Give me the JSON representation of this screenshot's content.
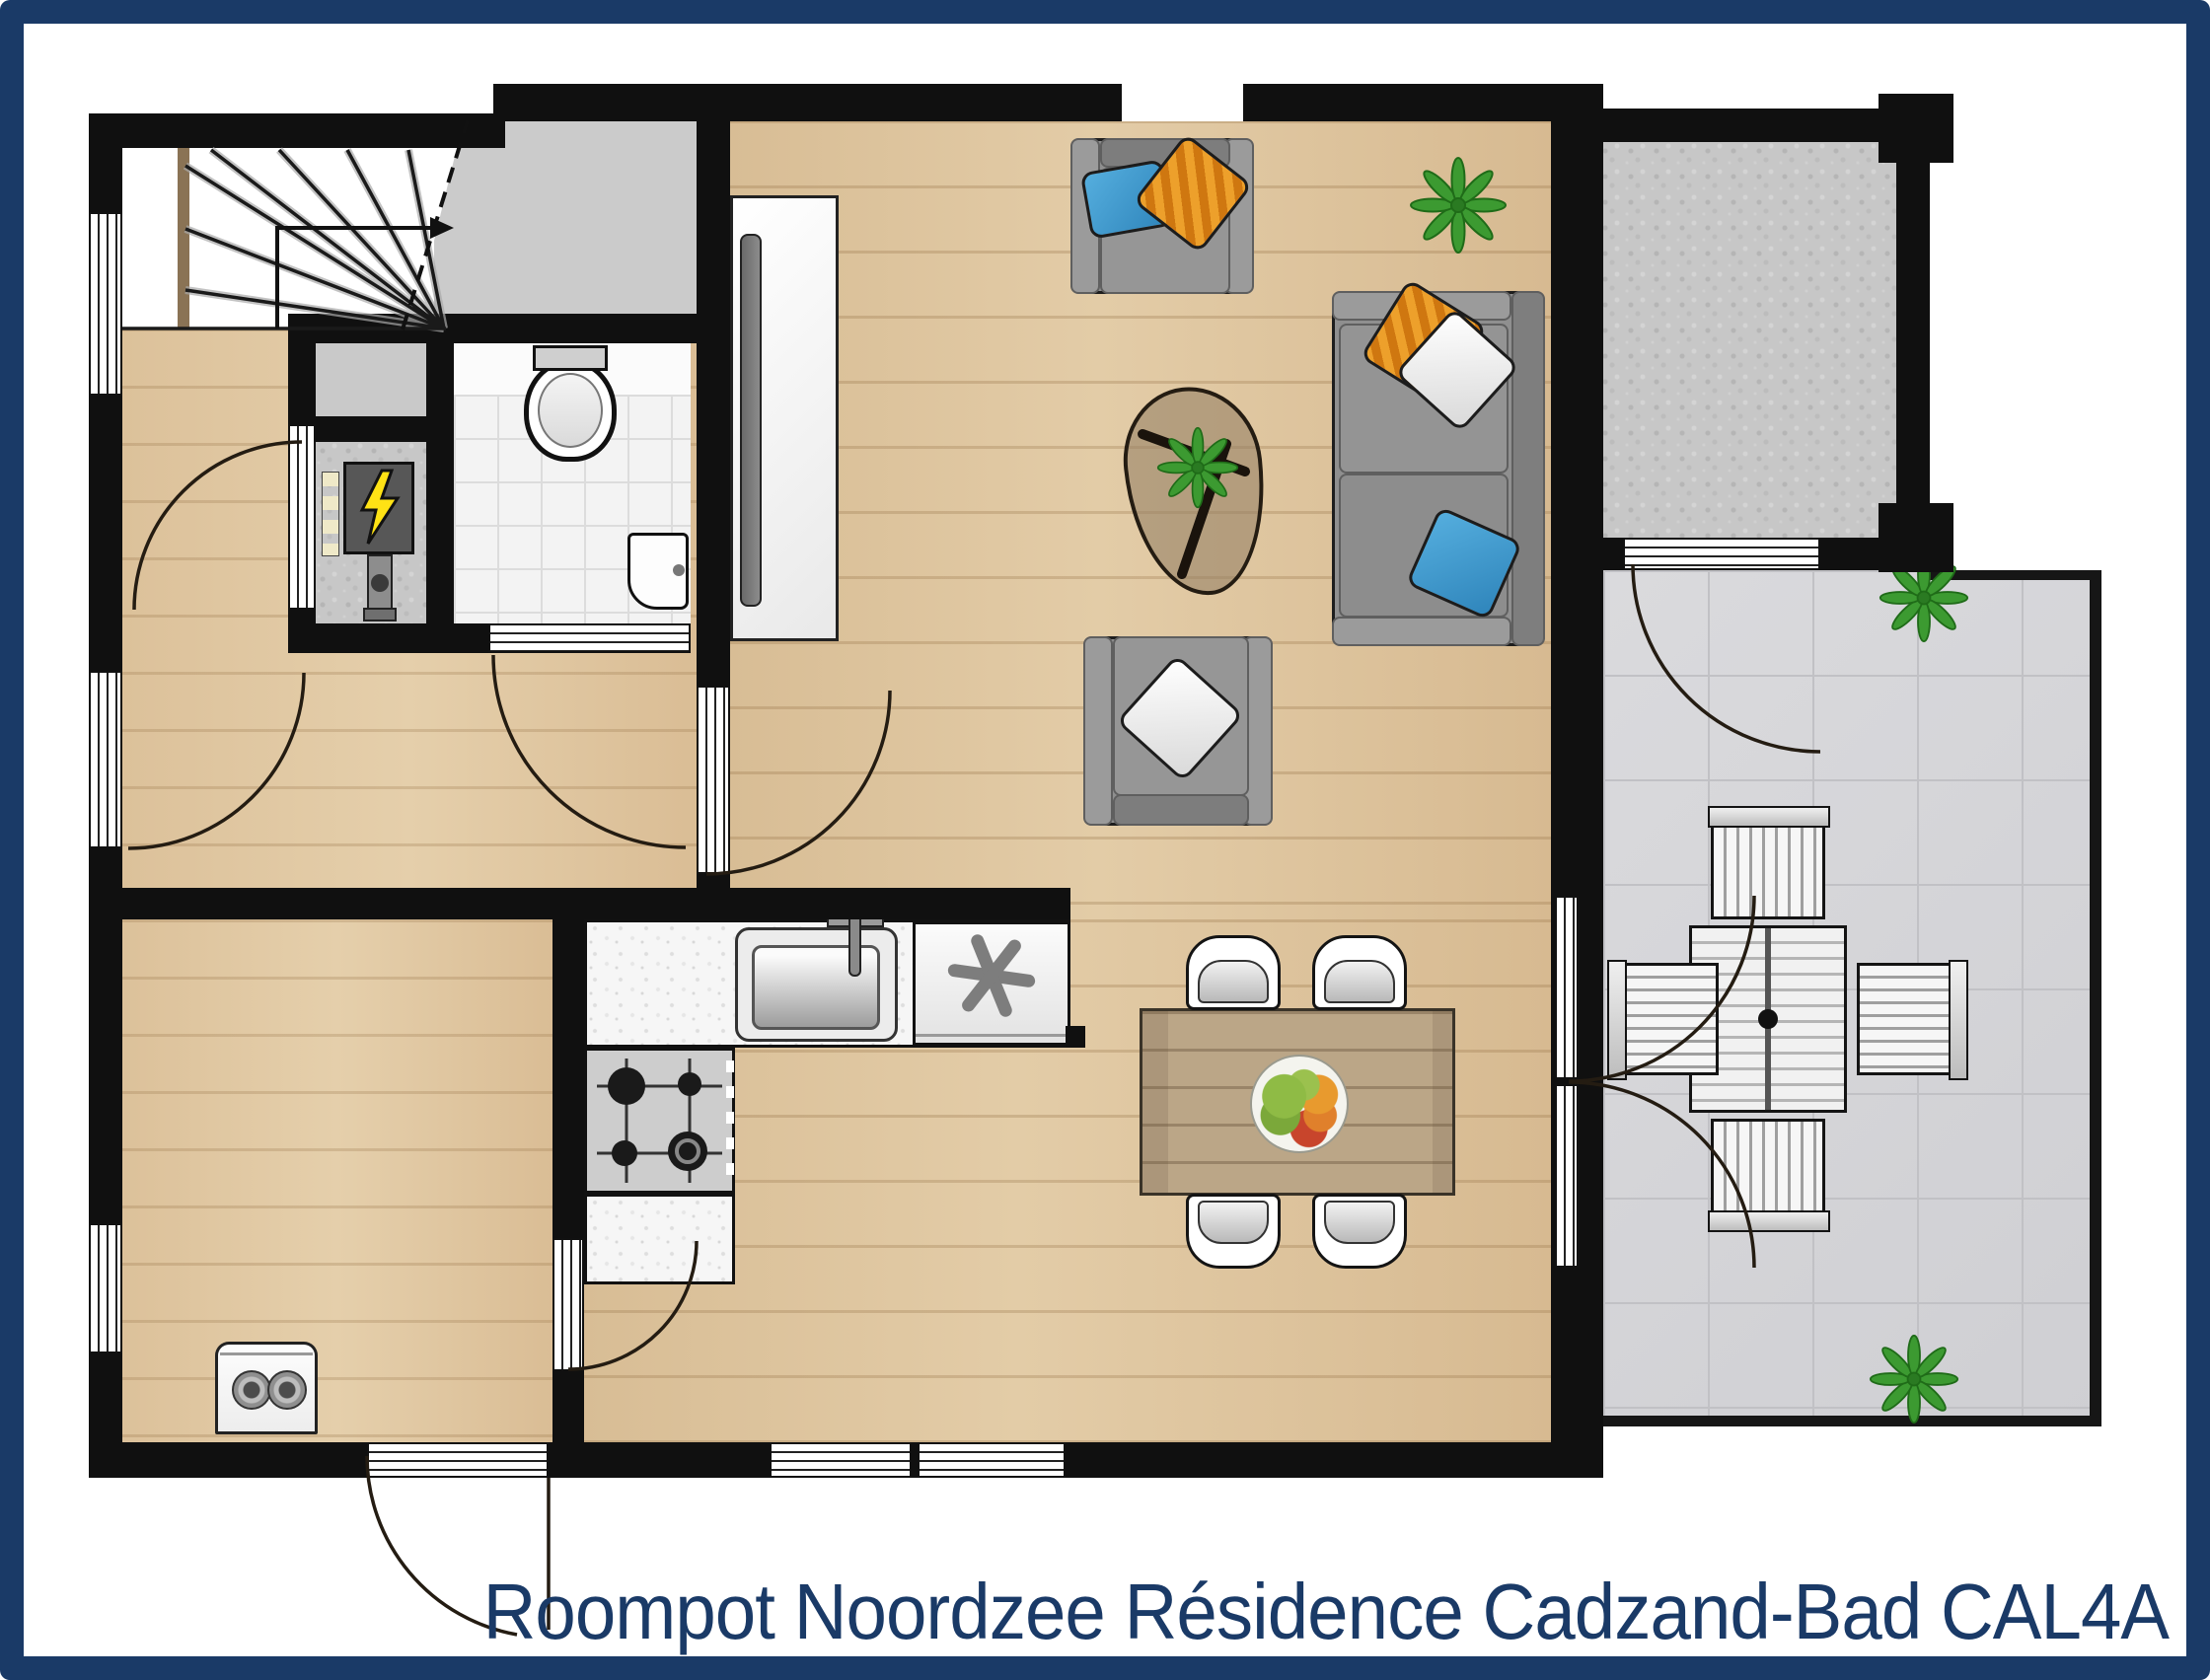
{
  "title": {
    "text": "Roompot Noordzee Résidence Cadzand-Bad CAL4A"
  },
  "theme": {
    "frame_color": "#1a3a67",
    "title_color": "#1a3a67",
    "wall_color": "#101010",
    "wood_floor_color": "#dcc29b",
    "terrace_tile_color": "#d7d7da",
    "landing_color": "#cbcbcb",
    "pillow_blue": "#3f97c9",
    "pillow_orange": "#e6961f",
    "plant_green": "#3c9a31"
  },
  "icons": [
    "staircase-icon",
    "stair-direction-arrow-icon",
    "toilet-icon",
    "hand-basin-icon",
    "electrical-panel-icon",
    "water-pipe-icon",
    "tv-icon",
    "kitchen-sink-icon",
    "gas-stove-icon",
    "freezer-icon",
    "dining-table-icon",
    "fruit-bowl-icon",
    "dining-chair-icon",
    "sofa-icon",
    "armchair-icon",
    "coffee-table-icon",
    "plant-icon",
    "washing-machine-icon",
    "terrace-table-icon",
    "terrace-chair-icon",
    "door-swing-icon",
    "window-icon"
  ]
}
